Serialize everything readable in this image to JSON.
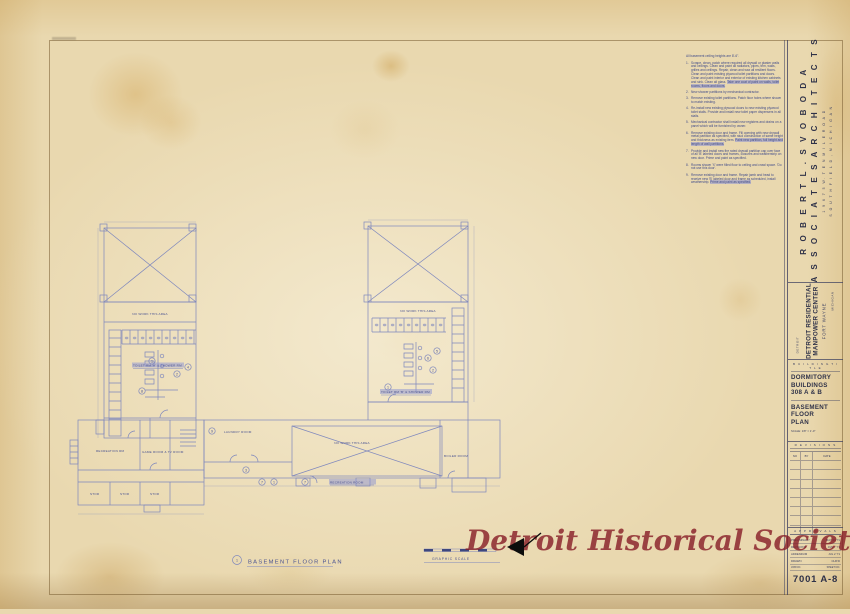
{
  "colors": {
    "paper": "#e9d8af",
    "line_blue": "#7e87bd",
    "text_blue": "#4a5391",
    "ink_dark": "#2e3148",
    "watermark_red": "#861c26",
    "highlight": "#8a92d4"
  },
  "title_block": {
    "architect": {
      "name_line1": "R O B E R T   L .   S V O B O D A",
      "name_line2": "A S S O C I A T E S   A R C H I T E C T S",
      "address_line1": "1 9 6 7 5   W.   T E N   M I L E   R O A D",
      "address_line2": "S O U T H F I E L D ,   M I C H I G A N"
    },
    "project": {
      "line1": "DETROIT  RESIDENTIAL",
      "line2": "MANPOWER  CENTER",
      "line3": "FORT  WAYNE",
      "city": "DETROIT",
      "state": "MICHIGAN"
    },
    "sheet": {
      "section_header": "B U I L D I N G   T I T L E",
      "building_line1": "DORMITORY",
      "building_line2": "BUILDINGS",
      "building_line3": "308 A & B",
      "title_line1": "BASEMENT",
      "title_line2": "FLOOR",
      "title_line3": "PLAN",
      "scale_note": "SCALE: 1/8\" = 1'-0\""
    },
    "revisions": {
      "section_header": "R E V I S I O N S",
      "col_no": "NO",
      "col_by": "BY",
      "col_date": "DATE"
    },
    "approvals": {
      "section_header": "A P P R O V A L S",
      "rows": [
        [
          "PRELIMINARY",
          "MAY 24 '71"
        ],
        [
          "REVISIONS",
          "JUN 7 '71"
        ],
        [
          "ADDENDUM",
          "JUL 2 '71"
        ],
        [
          "DRAWN",
          "CHK'D"
        ]
      ],
      "job_label": "JOB NO.",
      "sheet_label": "SHEET NO.",
      "sheet_number": "7001 A-8"
    }
  },
  "notes": {
    "intro": "All basement ceiling heights are 8'-6\".",
    "items": [
      {
        "num": "1.",
        "text": "Scrape, clean, patch where required all drywall or plaster walls and ceilings. Clean and paint all radiators, pipes, trim, walls, grilles and ceilings. Repair, clean and wax all resilient floors. Clean and paint existing plywood toilet partitions and doors. Clean and paint interior and exterior of existing kitchen cabinets and sink. Clean all glass.",
        "hl": "Take one coat of paint on walls, toilet rooms, floors and doors."
      },
      {
        "num": "2.",
        "text": "New shower partitions by mechanical contractor.",
        "hl": ""
      },
      {
        "num": "3.",
        "text": "Remove existing toilet partitions. Patch floor holes where shown to match existing.",
        "hl": ""
      },
      {
        "num": "4.",
        "text": "Re-install new existing plywood doors to new existing plywood toilet stalls. Provide and install new toilet paper dispensers in all stalls.",
        "hl": ""
      },
      {
        "num": "5.",
        "text": "Mechanical contractor shall install new registers and drains on a panel which will be furnished by owner.",
        "hl": ""
      },
      {
        "num": "6.",
        "text": "Remove existing door and frame. Fill opening with new drywall metal partition as specified, with stud construction of same height and thickness as existing item.",
        "hl": "Paint new partition, full height and length of wall partitions."
      },
      {
        "num": "7.",
        "text": "Provide and install new fire rated drywall partition cap over face of all 'B' labeled doors and frames, closures and weatherstrip on new door. Prime and paint as specified.",
        "hl": ""
      },
      {
        "num": "8.",
        "text": "Rooms shown 'X' were filled floor to ceiling and crawl space. 'Do not use this door'.",
        "hl": ""
      },
      {
        "num": "9.",
        "text": "Remove existing door and frame. Repair jamb and head to receive new 'B' labeled door and frame as scheduled, install weatherstrip.",
        "hl": "Prime and paint as specified."
      }
    ]
  },
  "plan": {
    "labels": {
      "no_work_a": "NO WORK THIS AREA",
      "no_work_b": "NO WORK THIS AREA",
      "no_work_c": "NO WORK THIS AREA",
      "toilet_a": "TOILET RM 'A' & SHOWER RM",
      "toilet_b": "TOILET RM 'B' & SHOWER RM",
      "laundry": "LAUNDRY ROOM",
      "boiler": "BOILER ROOM",
      "recreation_left": "RECREATION RM",
      "game": "GAME ROOM & TV ROOM",
      "recreation": "RECREATION ROOM",
      "stor1": "STOR",
      "stor2": "STOR",
      "stor3": "STOR"
    },
    "refs": {
      "a1": "1",
      "a2": "2",
      "a4": "4",
      "a8": "8",
      "b5": "5",
      "b6": "6",
      "b2": "2",
      "b1": "1",
      "w7": "7",
      "w1": "1",
      "w7b": "7",
      "w9": "9",
      "w3": "3"
    },
    "title_ref": "1",
    "title": "BASEMENT  FLOOR  PLAN",
    "graphic_scale": "GRAPHIC  SCALE"
  },
  "watermark": {
    "text": "Detroit Historical Society"
  }
}
